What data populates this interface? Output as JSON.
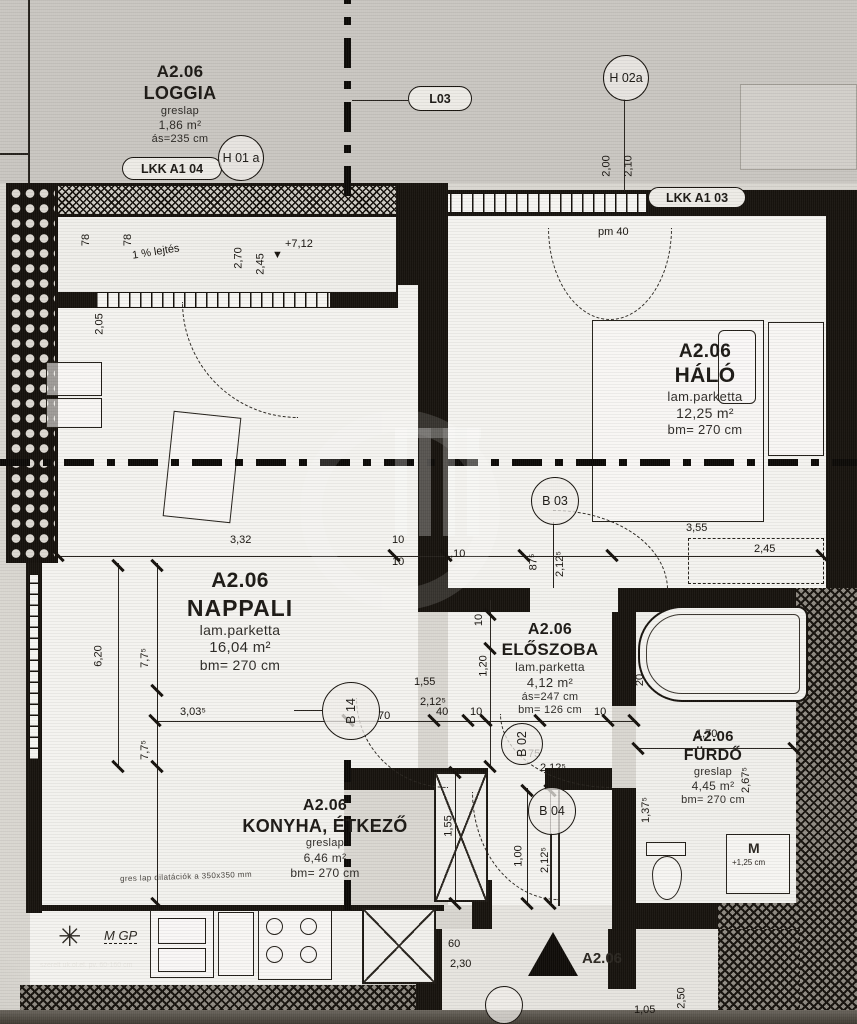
{
  "unit": {
    "code": "A2.06"
  },
  "rooms": {
    "loggia": {
      "code": "A2.06",
      "name": "LOGGIA",
      "floor": "greslap",
      "area": "1,86 m²",
      "line4": "ás=235 cm"
    },
    "halo": {
      "code": "A2.06",
      "name": "HÁLÓ",
      "floor": "lam.parketta",
      "area": "12,25 m²",
      "line4": "bm= 270 cm"
    },
    "nappali": {
      "code": "A2.06",
      "name": "NAPPALI",
      "floor": "lam.parketta",
      "area": "16,04 m²",
      "line4": "bm= 270 cm"
    },
    "eloszoba": {
      "code": "A2.06",
      "name": "ELŐSZOBA",
      "floor": "lam.parketta",
      "area": "4,12 m²",
      "line4": "ás=247 cm",
      "line5": "bm= 126 cm"
    },
    "furdo": {
      "code": "A2.06",
      "name": "FÜRDŐ",
      "floor": "greslap",
      "area": "4,45 m²",
      "line4": "bm= 270 cm"
    },
    "konyha": {
      "code": "A2.06",
      "name": "KONYHA, ÉTKEZŐ",
      "floor": "greslap",
      "area": "6,46 m²",
      "line4": "bm= 270 cm"
    }
  },
  "markers": {
    "pills": [
      {
        "label": "LKK A1 04",
        "x": 122,
        "y": 157,
        "w": 100,
        "h": 23
      },
      {
        "label": "L03",
        "x": 408,
        "y": 86,
        "w": 64,
        "h": 25
      },
      {
        "label": "LKK A1 03",
        "x": 648,
        "y": 187,
        "w": 98,
        "h": 21
      }
    ],
    "circles": [
      {
        "label": "H 01 a",
        "x": 218,
        "y": 135,
        "d": 46
      },
      {
        "label": "H 02a",
        "x": 603,
        "y": 55,
        "d": 46
      },
      {
        "label": "B 03",
        "x": 531,
        "y": 477,
        "d": 48
      },
      {
        "label": "B 14",
        "x": 322,
        "y": 682,
        "d": 58,
        "rot": -90
      },
      {
        "label": "B 02",
        "x": 501,
        "y": 723,
        "d": 42,
        "rot": -90
      },
      {
        "label": "B 04",
        "x": 528,
        "y": 787,
        "d": 48
      },
      {
        "label": "",
        "x": 485,
        "y": 986,
        "d": 38
      }
    ]
  },
  "entrance": {
    "label": "A2.06"
  },
  "annotations": {
    "kitchen_note": "gres lap dilatációk a 350x350 mm",
    "bottom_note": "szerelt uk.ol.el. pv. 60-160 cm",
    "mgp": "M GP",
    "machine": "M",
    "machine_level": "+1,25 cm",
    "star": "✳"
  },
  "dimensions": [
    {
      "t": "78",
      "x": 80,
      "y": 234,
      "v": 1
    },
    {
      "t": "78",
      "x": 122,
      "y": 234,
      "v": 1
    },
    {
      "t": "2,70",
      "x": 228,
      "y": 252,
      "v": 1
    },
    {
      "t": "2,45",
      "x": 250,
      "y": 258,
      "v": 1
    },
    {
      "t": "+7,12",
      "x": 285,
      "y": 238
    },
    {
      "t": "▼",
      "x": 272,
      "y": 249
    },
    {
      "t": "1 % lejtés",
      "x": 132,
      "y": 246,
      "r": -9
    },
    {
      "t": "2,00",
      "x": 596,
      "y": 160,
      "v": 1
    },
    {
      "t": "2,10",
      "x": 618,
      "y": 160,
      "v": 1
    },
    {
      "t": "pm 40",
      "x": 598,
      "y": 226
    },
    {
      "t": "2,05",
      "x": 89,
      "y": 318,
      "v": 1
    },
    {
      "t": "3,32",
      "x": 230,
      "y": 534
    },
    {
      "t": "10",
      "x": 392,
      "y": 534
    },
    {
      "t": "10",
      "x": 392,
      "y": 556
    },
    {
      "t": "1,10",
      "x": 444,
      "y": 548
    },
    {
      "t": "87⁵",
      "x": 525,
      "y": 556,
      "v": 1
    },
    {
      "t": "2,12⁵",
      "x": 547,
      "y": 558,
      "v": 1
    },
    {
      "t": "3,55",
      "x": 686,
      "y": 522
    },
    {
      "t": "2,45",
      "x": 754,
      "y": 543
    },
    {
      "t": "6,20",
      "x": 88,
      "y": 650,
      "v": 1
    },
    {
      "t": "7,7⁵",
      "x": 135,
      "y": 652,
      "v": 1
    },
    {
      "t": "7,7⁵",
      "x": 135,
      "y": 744,
      "v": 1
    },
    {
      "t": "3,03⁵",
      "x": 180,
      "y": 706
    },
    {
      "t": "1,55",
      "x": 414,
      "y": 676
    },
    {
      "t": "2,12⁵",
      "x": 420,
      "y": 696
    },
    {
      "t": "70",
      "x": 378,
      "y": 710
    },
    {
      "t": "40",
      "x": 436,
      "y": 706
    },
    {
      "t": "10",
      "x": 470,
      "y": 706
    },
    {
      "t": "10",
      "x": 594,
      "y": 706
    },
    {
      "t": "10",
      "x": 473,
      "y": 614,
      "v": 1
    },
    {
      "t": "1,20",
      "x": 473,
      "y": 660,
      "v": 1
    },
    {
      "t": "75",
      "x": 528,
      "y": 748
    },
    {
      "t": "2,12⁵",
      "x": 540,
      "y": 762
    },
    {
      "t": "1,70",
      "x": 696,
      "y": 728
    },
    {
      "t": "2,67⁵",
      "x": 733,
      "y": 774,
      "v": 1
    },
    {
      "t": "1,37⁵",
      "x": 633,
      "y": 804,
      "v": 1
    },
    {
      "t": "1,55",
      "x": 438,
      "y": 820,
      "v": 1
    },
    {
      "t": "1,00",
      "x": 508,
      "y": 850,
      "v": 1
    },
    {
      "t": "2,12⁵",
      "x": 532,
      "y": 854,
      "v": 1
    },
    {
      "t": "20",
      "x": 634,
      "y": 674,
      "v": 1
    },
    {
      "t": "60",
      "x": 448,
      "y": 938
    },
    {
      "t": "2,30",
      "x": 450,
      "y": 958
    },
    {
      "t": "75",
      "x": 615,
      "y": 964,
      "v": 1
    },
    {
      "t": "2,50",
      "x": 671,
      "y": 992,
      "v": 1
    },
    {
      "t": "1,05",
      "x": 634,
      "y": 1004
    }
  ]
}
